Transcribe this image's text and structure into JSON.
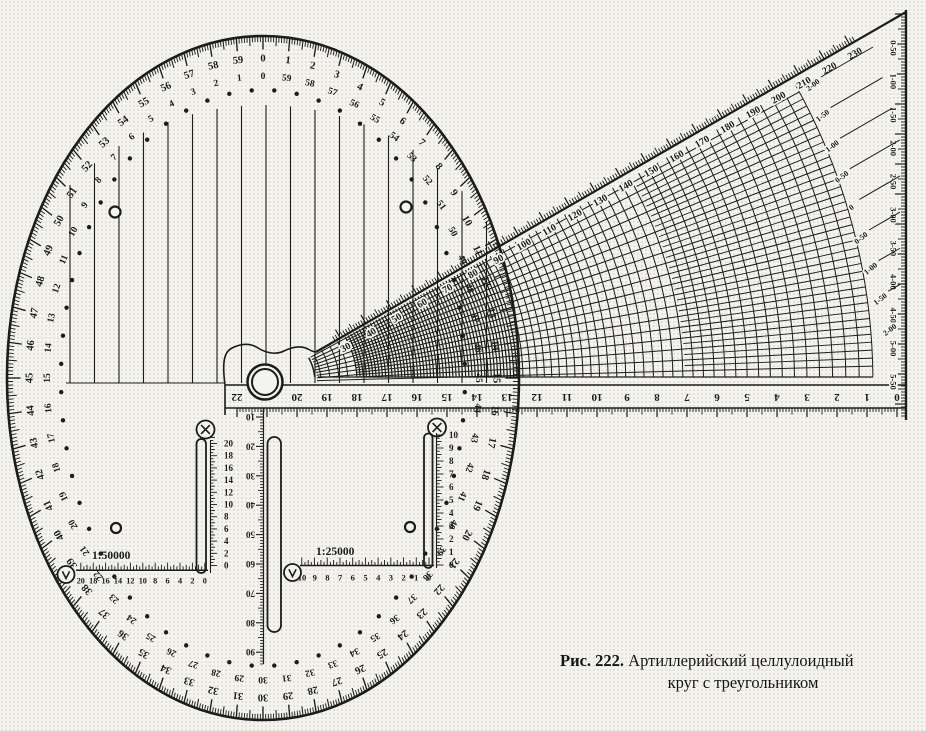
{
  "figure": {
    "caption_prefix": "Рис. 222.",
    "caption_line1": "Артиллерийский целлулоидный",
    "caption_line2": "круг с треугольником"
  },
  "colors": {
    "ink": "#1c1c1c",
    "paper": "#f4f3ee"
  },
  "disc": {
    "divisions": 60,
    "outer_ring_numbers": [
      0,
      1,
      2,
      3,
      4,
      5,
      6,
      7,
      8,
      9,
      10,
      11,
      12,
      13,
      14,
      15,
      16,
      17,
      18,
      19,
      20,
      21,
      22,
      23,
      24,
      25,
      26,
      27,
      28,
      29,
      30,
      31,
      32,
      33,
      34,
      35,
      36,
      37,
      38,
      39,
      40,
      41,
      42,
      43,
      44,
      45,
      46,
      47,
      48,
      49,
      50,
      51,
      52,
      53,
      54,
      55,
      56,
      57,
      58,
      59
    ],
    "inner_ring_numbers": [
      0,
      59,
      58,
      57,
      56,
      55,
      54,
      53,
      52,
      51,
      50,
      49,
      48,
      47,
      46,
      45,
      44,
      43,
      42,
      41,
      40,
      39,
      38,
      37,
      36,
      35,
      34,
      33,
      32,
      31,
      30,
      29,
      28,
      27,
      26,
      25,
      24,
      23,
      22,
      21,
      20,
      19,
      18,
      17,
      16,
      15,
      14,
      13,
      12,
      11,
      10,
      9,
      8,
      7,
      6,
      5,
      4,
      3,
      2,
      1
    ]
  },
  "triangle": {
    "ruler_numbers": [
      22,
      20,
      19,
      18,
      17,
      16,
      15,
      14,
      13,
      12,
      11,
      10,
      9,
      8,
      7,
      6,
      5,
      4,
      3,
      2,
      1,
      0
    ],
    "hypotenuse_numbers": [
      30,
      40,
      50,
      60,
      70,
      80,
      90,
      100,
      110,
      120,
      130,
      140,
      150,
      160,
      170,
      180,
      190,
      200,
      210,
      220,
      230
    ],
    "right_edge_labels": [
      "0-50",
      "1-00",
      "1-50",
      "2-00",
      "2-50",
      "3-00",
      "3-50",
      "4-00",
      "4-50",
      "5-00",
      "5-50"
    ],
    "corner_labels": [
      "2-00",
      "1-50",
      "1-00",
      "0-50",
      "0",
      "0-50",
      "1-00",
      "1-50",
      "2-00"
    ]
  },
  "center_scale": {
    "numbers": [
      10,
      20,
      30,
      40,
      50,
      60,
      70,
      80,
      90
    ]
  },
  "map_scales": [
    {
      "label": "1:50000",
      "horizontal_numbers": [
        20,
        18,
        16,
        14,
        12,
        10,
        8,
        6,
        4,
        2,
        0
      ],
      "vertical_numbers": [
        0,
        2,
        4,
        6,
        8,
        10,
        12,
        14,
        16,
        18,
        20
      ]
    },
    {
      "label": "1:25000",
      "horizontal_numbers": [
        10,
        9,
        8,
        7,
        6,
        5,
        4,
        3,
        2,
        1,
        0
      ],
      "vertical_numbers": [
        0,
        1,
        2,
        3,
        4,
        5,
        6,
        7,
        8,
        9,
        10
      ]
    }
  ]
}
